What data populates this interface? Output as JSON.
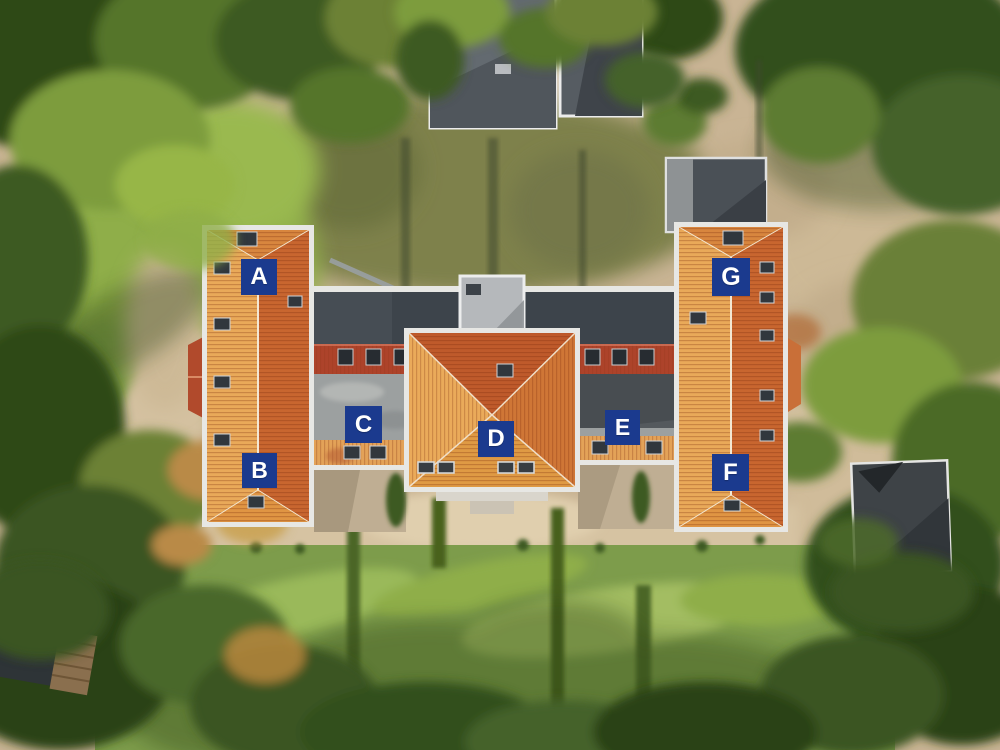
{
  "photo": {
    "alt": "Aerial drone view of a large U-shaped apartment building with orange tiled roofs and flat grey roof sections, surrounded by trees, lawns and sandy paths"
  },
  "marker": {
    "bg_color": "#1b3a8e",
    "text_color": "#ffffff"
  },
  "unit_labels": [
    {
      "letter": "A",
      "x": 241,
      "y": 259,
      "size": 36
    },
    {
      "letter": "B",
      "x": 242,
      "y": 453,
      "size": 35
    },
    {
      "letter": "C",
      "x": 345,
      "y": 406,
      "size": 37
    },
    {
      "letter": "D",
      "x": 478,
      "y": 421,
      "size": 36
    },
    {
      "letter": "E",
      "x": 605,
      "y": 410,
      "size": 35
    },
    {
      "letter": "F",
      "x": 712,
      "y": 454,
      "size": 37
    },
    {
      "letter": "G",
      "x": 712,
      "y": 258,
      "size": 38
    }
  ]
}
